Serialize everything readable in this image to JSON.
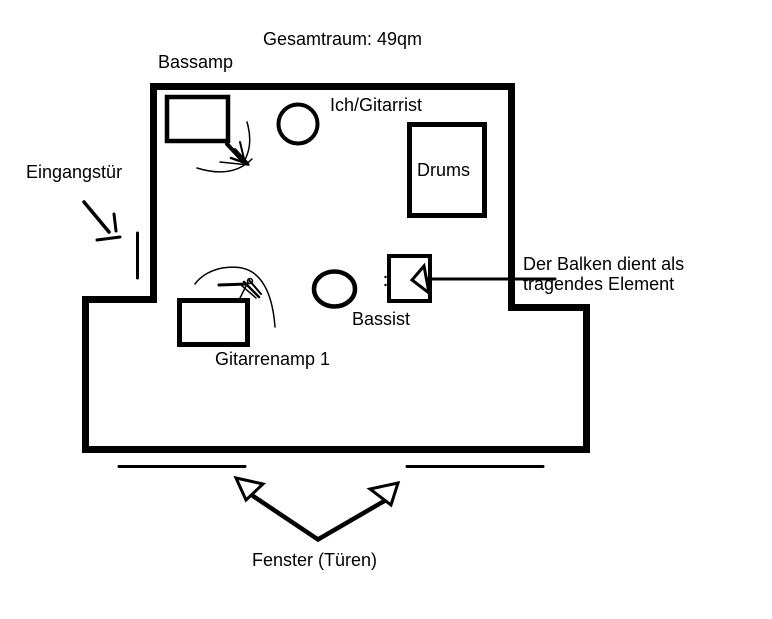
{
  "diagram": {
    "title": "Gesamtraum: 49qm",
    "room": {
      "entrance_label": "Eingangstür",
      "window_label": "Fenster (Türen)",
      "beam_note_line1": "Der Balken dient als",
      "beam_note_line2": "tragendes Element"
    },
    "equipment": {
      "bassamp": "Bassamp",
      "guitar_amp": "Gitarrenamp 1",
      "drums": "Drums"
    },
    "people": {
      "guitarist": "Ich/Gitarrist",
      "bassist": "Bassist"
    },
    "shapes": [
      "room-outline-with-step",
      "bassamp-box",
      "guitar-amp-box",
      "drums-box",
      "guitarist-circle",
      "bassist-circle",
      "beam-box",
      "entrance-arrow",
      "door-line",
      "window-line-left",
      "window-line-right",
      "window-v-arrows",
      "beam-pointer-arrow",
      "scribble-arrow-bassamp",
      "scribble-arrow-guitaramp"
    ],
    "colors": {
      "ink": "#000000",
      "background": "#ffffff"
    }
  }
}
